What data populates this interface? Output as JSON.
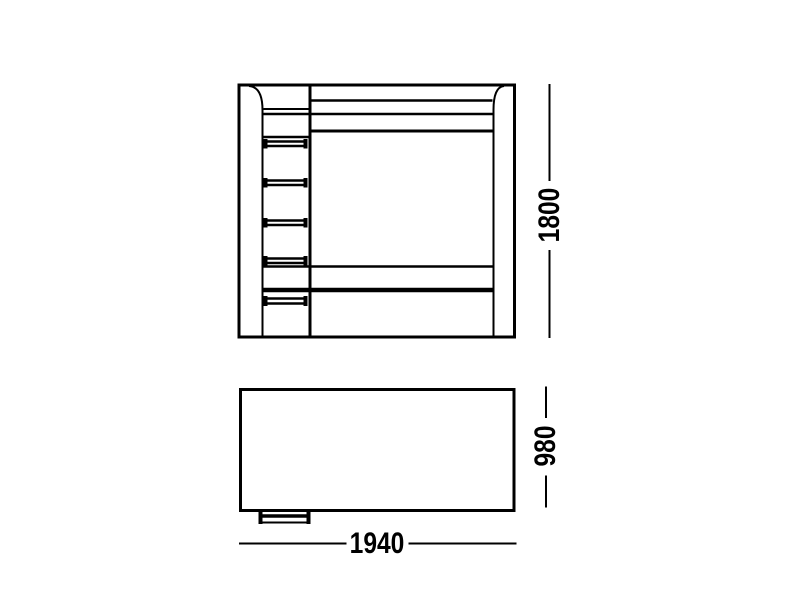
{
  "colors": {
    "line": "#000000",
    "background": "#ffffff"
  },
  "front_view": {
    "height_label": "1800"
  },
  "plan_view": {
    "width_label": "1940",
    "depth_label": "980"
  }
}
